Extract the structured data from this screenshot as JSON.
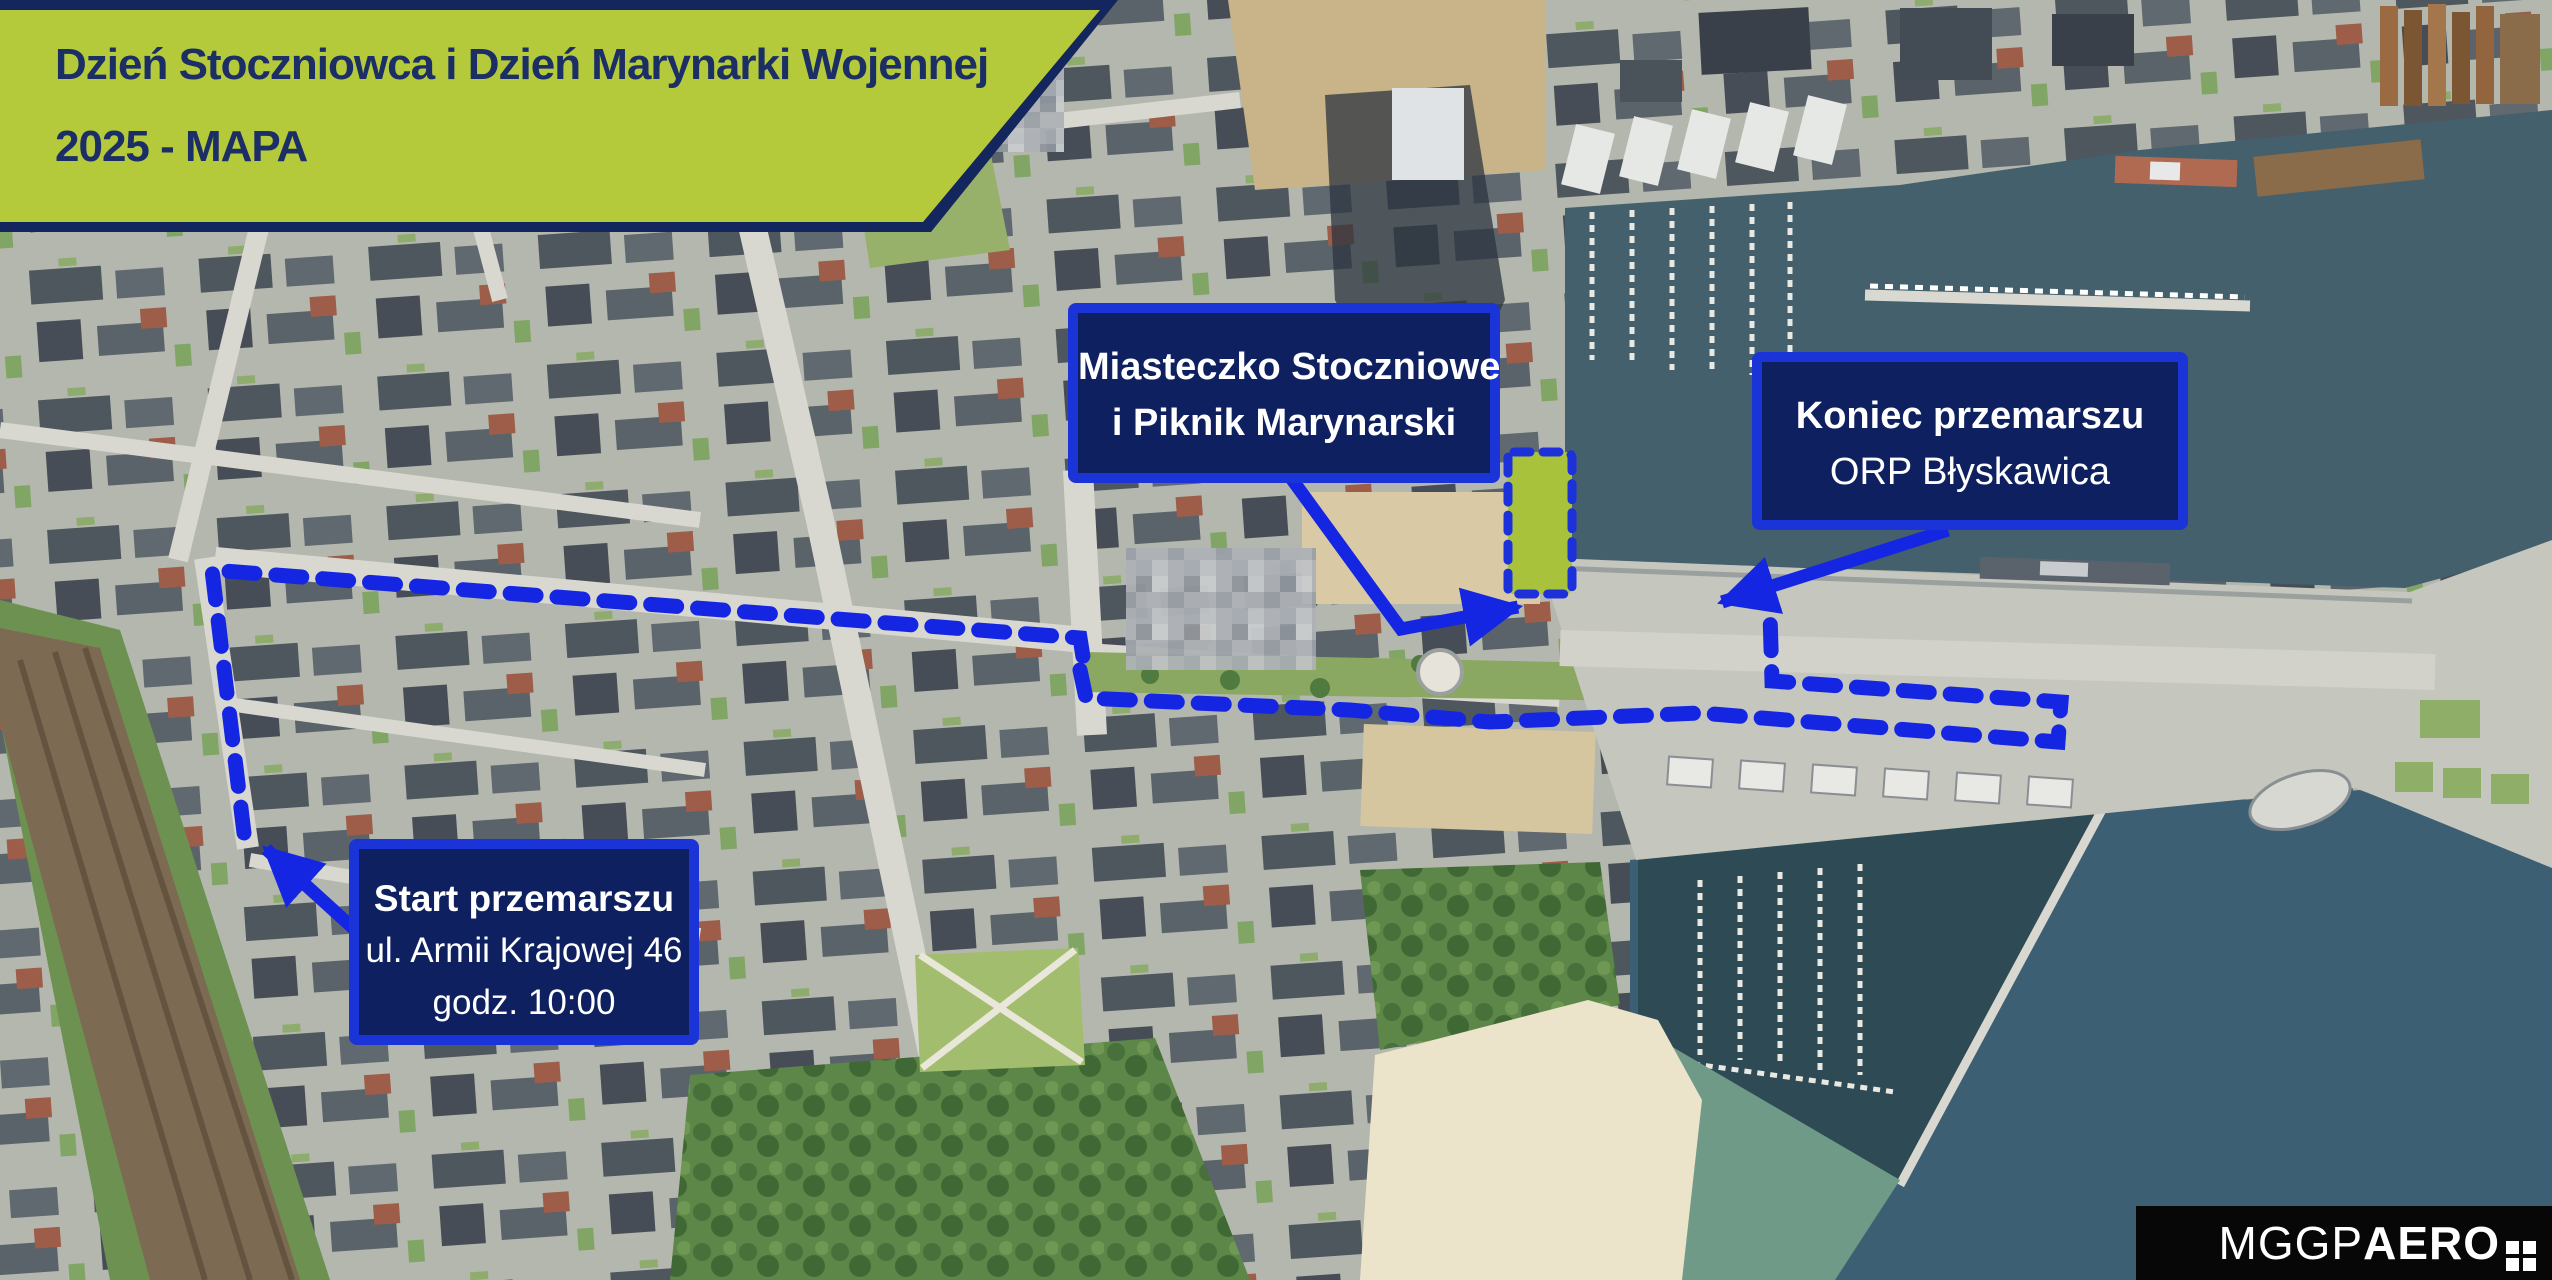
{
  "banner": {
    "line1": "Dzień Stoczniowca i Dzień Marynarki Wojennej",
    "line2": "2025 - MAPA"
  },
  "annotations": {
    "miasteczko": {
      "line1": "Miasteczko Stoczniowe",
      "line2": "i Piknik Marynarski"
    },
    "koniec": {
      "title": "Koniec przemarszu",
      "subtitle": "ORP Błyskawica"
    },
    "start": {
      "title": "Start przemarszu",
      "address": "ul. Armii Krajowej 46",
      "time": "godz. 10:00"
    }
  },
  "logo": {
    "brand_regular": "MGGP",
    "brand_bold": "AERO"
  },
  "colors": {
    "banner_green": "#b5ca3b",
    "banner_text_navy": "#1c2e66",
    "label_fill_navy": "#0e2060",
    "label_border_blue": "#1b34d8",
    "route_blue": "#1526e2",
    "zone_green": "#a9c23b",
    "water_dark": "#43606c",
    "sea_blue": "#3d5f73",
    "beach_sand": "#ece4ca"
  },
  "map_legend": {
    "route_style": "blue dashed line",
    "zone_style": "green rectangle with blue dashed outline"
  }
}
